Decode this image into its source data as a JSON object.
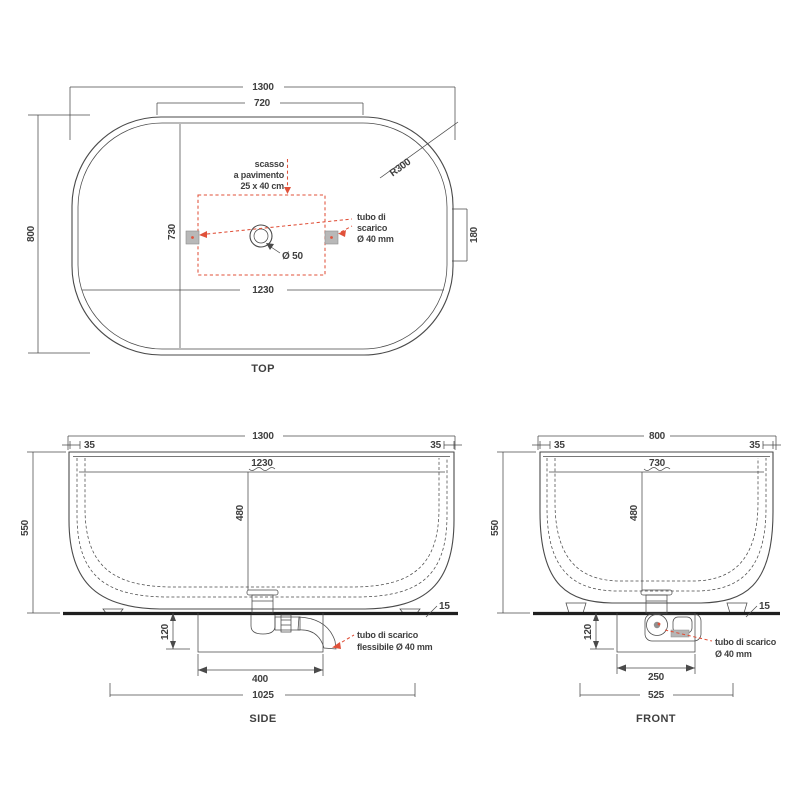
{
  "drawing_type": "bathtub technical drawing",
  "colors": {
    "line": "#4a4a4a",
    "text": "#3f3f3f",
    "accent_red": "#e0513a",
    "floor_line": "#1f1f1f",
    "recess_fill": "#ebebeb",
    "block_fill": "#b8b8b8",
    "hose_fill": "#c6c6c6"
  },
  "top": {
    "title": "TOP",
    "overall_length": "1300",
    "straight_length": "720",
    "overall_width": "800",
    "inner_width": "730",
    "inner_length": "1230",
    "corner_radius": "R300",
    "side_offset": "180",
    "drain_diameter": "Ø 50",
    "recess_note": [
      "scasso",
      "a pavimento",
      "25 x 40 cm"
    ],
    "pipe_note": [
      "tubo di",
      "scarico",
      "Ø 40 mm"
    ]
  },
  "side": {
    "title": "SIDE",
    "overall_length": "1300",
    "rim_left": "35",
    "rim_right": "35",
    "inner_length": "1230",
    "depth": "480",
    "height": "550",
    "base_gap": "15",
    "recess_depth": "120",
    "trap_width": "400",
    "base_length": "1025",
    "pipe_note": [
      "tubo di scarico",
      "flessibile Ø 40 mm"
    ]
  },
  "front": {
    "title": "FRONT",
    "overall_width": "800",
    "rim_left": "35",
    "rim_right": "35",
    "inner_width": "730",
    "depth": "480",
    "height": "550",
    "base_gap": "15",
    "recess_depth": "120",
    "trap_width": "250",
    "base_width": "525",
    "pipe_note": [
      "tubo di scarico",
      "Ø 40 mm"
    ]
  }
}
